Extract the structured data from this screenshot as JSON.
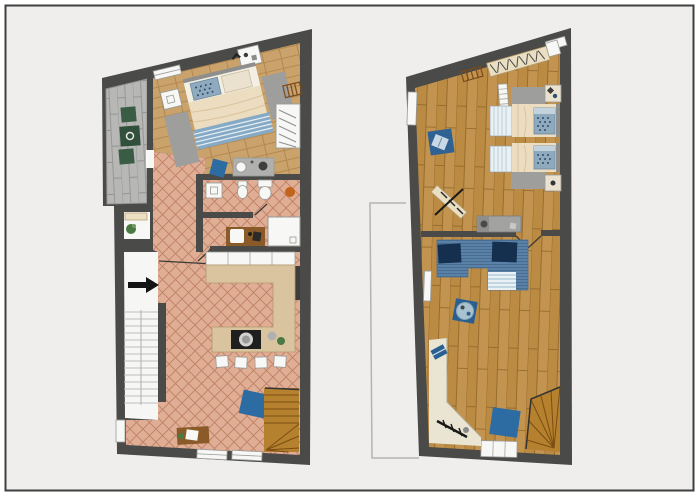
{
  "canvas": {
    "width": 700,
    "height": 500,
    "background": "#ffffff"
  },
  "frame": {
    "border_color": "#3f3f3e",
    "inner_background": "#efeeec"
  },
  "colors": {
    "page": "#ffffff",
    "background": "#efeeec",
    "frame_border": "#3f3f3e",
    "wall": "#4a4a48",
    "wall_dark": "#3d3d3b",
    "wood_light_base": "#c9a36b",
    "wood_light_line": "#ad8048",
    "wood_dark_base": "#bb8a43",
    "wood_dark_alt": "#c39450",
    "wood_dark_line": "#8d6426",
    "tile_base": "#e0ad95",
    "tile_line": "#bd8165",
    "paver_base": "#b7b7b5",
    "paver_line": "#949492",
    "white_fixture": "#f7f7f5",
    "fixture_border": "#999996",
    "counter_beige": "#d9c49f",
    "counter_border": "#b49a6e",
    "cooktop_black": "#1f1f1f",
    "duvet": "#ecdcc0",
    "sheet_white": "#f3efe3",
    "pillow_blue": "#8fa9bd",
    "pillow_dots": "#2e4f72",
    "pillow_beige": "#eae2cf",
    "blanket_stripe": "#86aac6",
    "rug_gray": "#9e9e9c",
    "sofa_base": "#5a82a8",
    "sofa_cushion": "#14304e",
    "throw_light": "#e9f1f5",
    "throw_stripe": "#a9c6d8",
    "rug_blue": "#2d6ca3",
    "rug_blue2": "#2f6292",
    "pouf_blue": "#2a5f91",
    "pouf_tray": "#a9c2cf",
    "stair_wood": "#b5812f",
    "stair_line": "#7a4d12",
    "table_green": "#31503c",
    "chair_green": "#3a5c44",
    "orange": "#c2641a",
    "desk_wood": "#8a5a28",
    "beige_zone": "#eae4d2",
    "beige_edge": "#b3a98f",
    "rail_beige": "#eadfc2",
    "ladder_brown": "#7a4a1a",
    "sideboard": "#a2a2a0",
    "sideboard_dark": "#8e8e8c",
    "ghost": "#b3b3b1",
    "arrow_black": "#141414",
    "stair_white": "#f6f6f4",
    "tread": "#bdbdbb",
    "plant_green": "#4a7a42",
    "door_line": "#3a3a38",
    "metal_gray": "#b0b0ae"
  },
  "plans": [
    {
      "id": "left-floor-plan",
      "name": "ground floor plan",
      "rooms": [
        {
          "name": "terrace",
          "floor": "gray pavers",
          "furniture": [
            "green garden table",
            "two green garden chairs"
          ]
        },
        {
          "name": "bedroom",
          "floor": "light oak planks",
          "furniture": [
            "double bed with blue dotted pillow and striped blanket",
            "two bedside rugs",
            "two nightstands",
            "open wardrobe with clothes",
            "wall ladder",
            "double washbasin counter",
            "blue chair"
          ]
        },
        {
          "name": "bathroom",
          "floor": "terracotta tiles",
          "furniture": [
            "washbasin unit",
            "bidet",
            "toilet",
            "orange stool",
            "shower",
            "wooden vanity with sink"
          ]
        },
        {
          "name": "kitchen-living-room",
          "floor": "terracotta tiles",
          "furniture": [
            "U-shaped beige kitchen counter",
            "black cooktop with pot",
            "four bar stools",
            "plant and bowl",
            "blue rug",
            "wooden desk with paper",
            "winder staircase"
          ]
        },
        {
          "name": "entry",
          "floor": "white",
          "furniture": [
            "interior staircase",
            "entrance arrow",
            "plant closet"
          ]
        }
      ]
    },
    {
      "id": "right-floor-plan",
      "name": "upper floor plan",
      "rooms": [
        {
          "name": "bedroom",
          "floor": "oak planks",
          "furniture": [
            "clothes rail with hangers",
            "wall ladder",
            "white shelf",
            "blue rug with book",
            "two single beds with blue dotted pillows",
            "two bedside rugs",
            "two nightstands",
            "skis with pole",
            "gray sideboard"
          ]
        },
        {
          "name": "living-room",
          "floor": "oak planks",
          "furniture": [
            "blue corner sofa with navy cushions",
            "striped throw",
            "blue pouf with tray",
            "white wall shelf",
            "sloped-ceiling alcove",
            "book",
            "sled",
            "blue rug",
            "winder staircase",
            "bottom door"
          ]
        }
      ]
    }
  ]
}
